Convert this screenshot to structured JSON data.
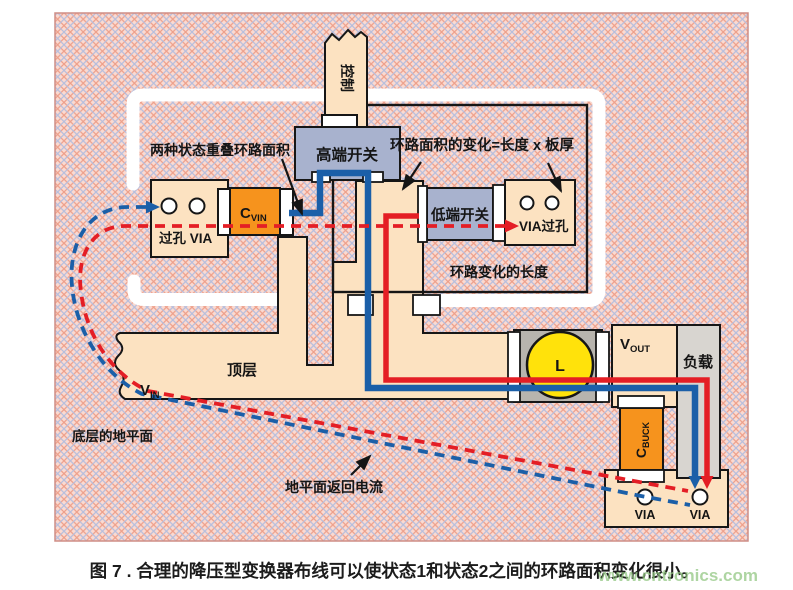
{
  "figure": {
    "caption": "图 7 . 合理的降压型变换器布线可以使状态1和状态2之间的环路面积变化很小。",
    "watermark": "www.cntronics.com"
  },
  "annotations": {
    "overlap_loop_area": "两种状态重叠环路面积",
    "loop_area_change": "环路面积的变化=长度 x 板厚",
    "loop_change_length": "环路变化的长度",
    "top_layer": "顶层",
    "bottom_ground_plane": "底层的地平面",
    "ground_return_current": "地平面返回电流"
  },
  "components": {
    "control": "控制",
    "high_side_switch": "高端开关",
    "low_side_switch": "低端开关",
    "cvin_main": "C",
    "cvin_sub": "VIN",
    "via_pad_left_label": "过孔  VIA",
    "via_pad_right_label": "VIA过孔",
    "inductor": "L",
    "vout_main": "V",
    "vout_sub": "OUT",
    "load": "负载",
    "cbuck_main": "C",
    "cbuck_sub": "BUCK",
    "vin_main": "V",
    "vin_sub": "IN",
    "via_bottom_left": "VIA",
    "via_bottom_right": "VIA"
  },
  "colors": {
    "state1_trace_blue": "#1b5fa8",
    "state2_trace_red": "#e41e25",
    "copper_beige": "#fce2c1",
    "switch_blue_gray": "#a8b2ce",
    "capacitor_orange": "#f6931d",
    "inductor_yellow": "#ffe20b",
    "load_gray": "#d8d5d0",
    "inductor_pad_gray": "#b7b4ae",
    "board_pink": "#fbdad1",
    "hatch_red": "#eda08b",
    "hatch_blue": "#b6bedd",
    "watermark_green": "#8fc57f"
  }
}
